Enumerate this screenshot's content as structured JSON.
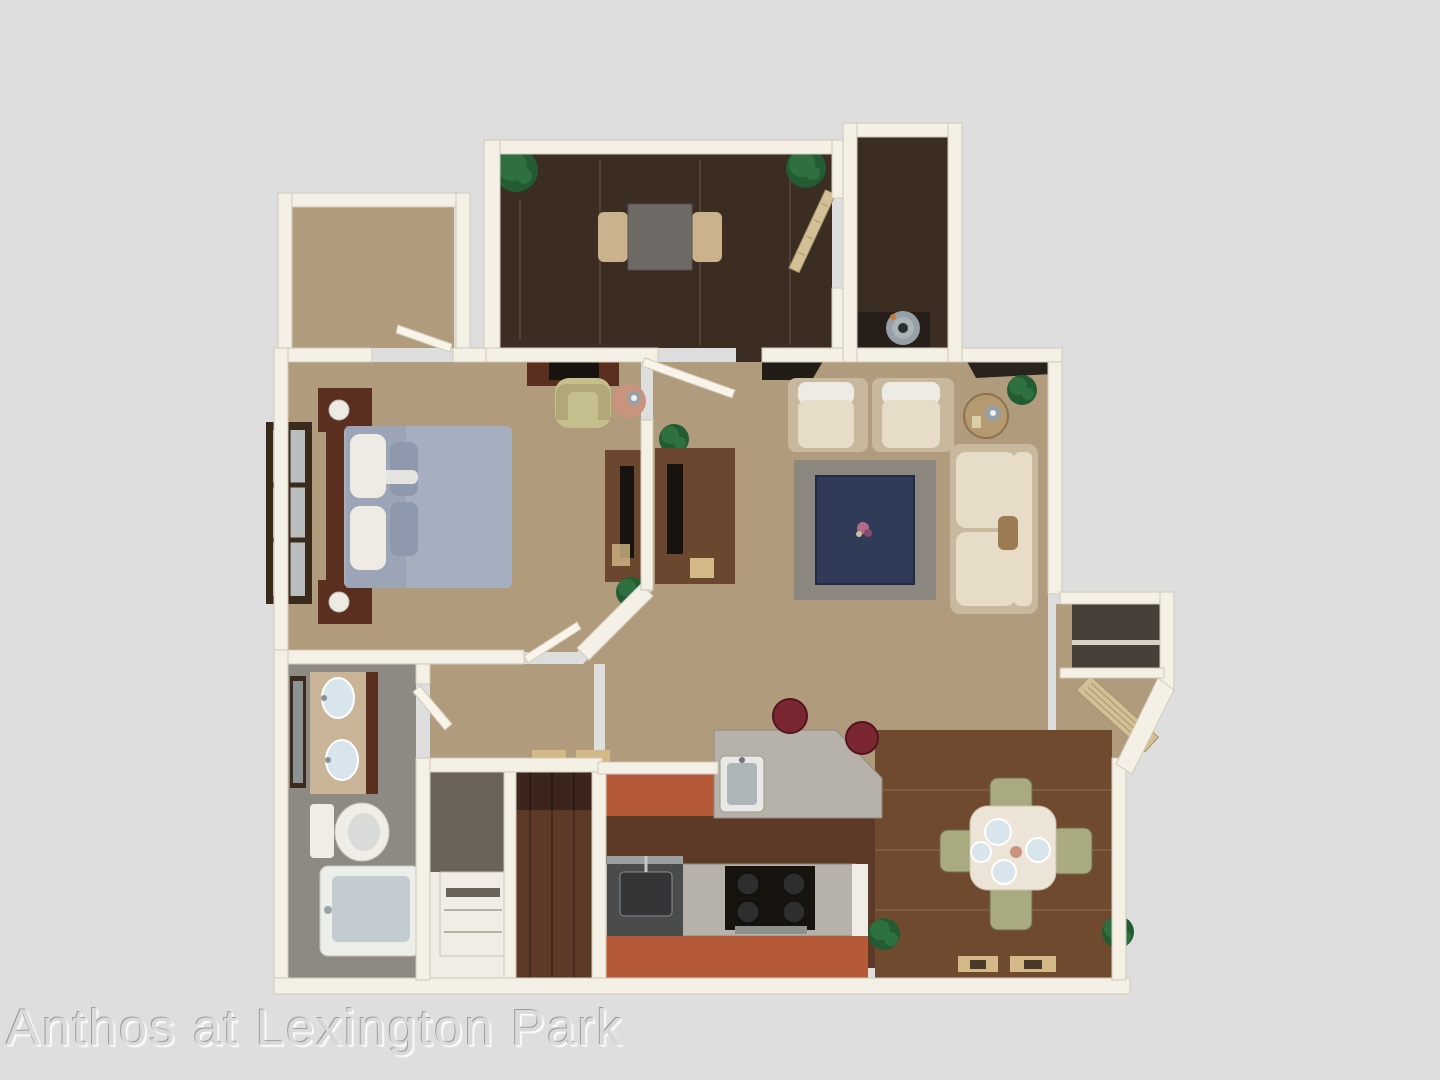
{
  "watermark": {
    "text": "Anthos at Lexington Park"
  },
  "scene": {
    "type": "3d-apartment-floor-plan-rendering",
    "rooms": [
      {
        "id": "walk-in-closet",
        "floor": "carpet"
      },
      {
        "id": "den-office",
        "floor": "woodDark"
      },
      {
        "id": "utility-closet",
        "floor": "woodDark"
      },
      {
        "id": "bedroom",
        "floor": "carpet"
      },
      {
        "id": "hallway-study-nook",
        "floor": "carpet"
      },
      {
        "id": "living-room",
        "floor": "carpet"
      },
      {
        "id": "bathroom",
        "floor": "bathFloor"
      },
      {
        "id": "laundry-closet",
        "floor": "woodRed"
      },
      {
        "id": "kitchen",
        "floor": "woodRed"
      },
      {
        "id": "dining-area",
        "floor": "woodMid"
      },
      {
        "id": "entry",
        "floor": "carpet"
      }
    ]
  },
  "palette": {
    "bg": "#dedede",
    "wall": "#f4f0e6",
    "wallShade": "#d0c9b7",
    "doorWhite": "#f8f4ea",
    "doorTan": "#d3c096",
    "carpet": "#b09c7d",
    "woodDark": "#3b2d22",
    "woodRed": "#5d3a28",
    "woodMid": "#6f4a2f",
    "bathFloor": "#8d8a84",
    "granite": "#b6b2a9",
    "cabinetOrange": "#b55a39",
    "cream": "#e6dcc8",
    "creamFrame": "#c8b99e",
    "rug": "#8b867e",
    "navy": "#2f3b57",
    "bed": "#a6afc0",
    "bedShade": "#8f99ad",
    "pillow": "#edebe4",
    "furnWood": "#5a2f1f",
    "deskWood": "#6b4730",
    "plant": "#2f7040",
    "plantDark": "#235c33",
    "sage": "#a9aa80",
    "chairYellow": "#c5bf8e",
    "pinkTable": "#c9947e",
    "stool": "#7b2732",
    "tub": "#eceeea",
    "tubInner": "#c2ccd1",
    "marble": "#c9b497",
    "sinkBlue": "#d9e5ec",
    "black": "#17130f",
    "steel": "#97a0a6",
    "fixtureWhite": "#f0ede6",
    "matTan": "#d3b988",
    "watermark": "#dadada"
  }
}
